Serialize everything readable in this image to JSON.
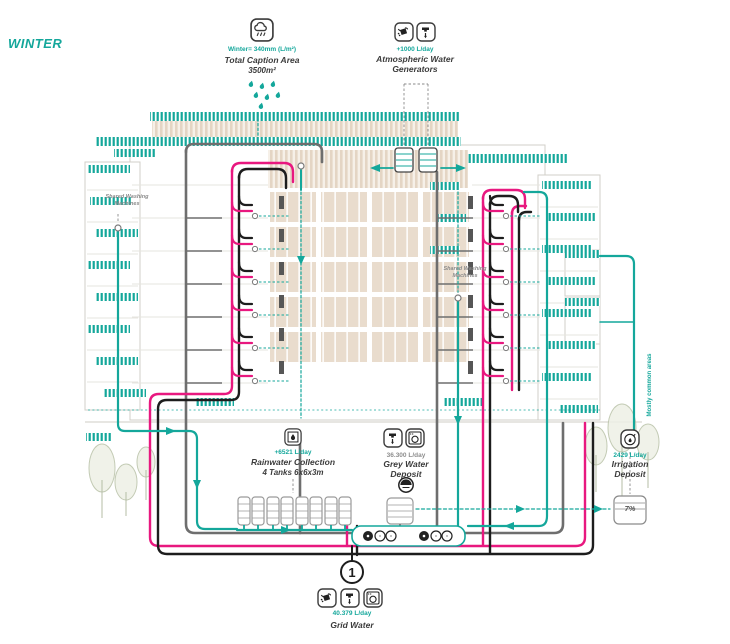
{
  "season": {
    "label": "WINTER"
  },
  "colors": {
    "teal": "#14a79b",
    "magenta": "#e8187f",
    "pipe_gray": "#6e6e6e",
    "pipe_black": "#1d1d1d",
    "beige": "#e9dccd"
  },
  "annotations": {
    "rainfall": {
      "value": "Winter= 340mm (L/m²)",
      "title": "Total Caption Area",
      "subtitle": "3500m²"
    },
    "atmospheric": {
      "value": "+1000 L/day",
      "title": "Atmospheric Water Generators"
    },
    "shared_washing": {
      "label": "Shared Washing Machines"
    },
    "rainwater": {
      "value": "+6521 L/day",
      "title": "Rainwater Collection",
      "subtitle": "4 Tanks 6x6x3m"
    },
    "greywater": {
      "value": "36.300 L/day",
      "title": "Grey Water Deposit"
    },
    "irrigation": {
      "value": "2429 L/day",
      "title": "Irrigation Deposit"
    },
    "common_areas": {
      "label": "Mostly common areas"
    },
    "irrigation_tank": {
      "level": "7%"
    },
    "grid": {
      "number": "1",
      "value": "40.379 L/day",
      "title": "Grid Water"
    }
  }
}
